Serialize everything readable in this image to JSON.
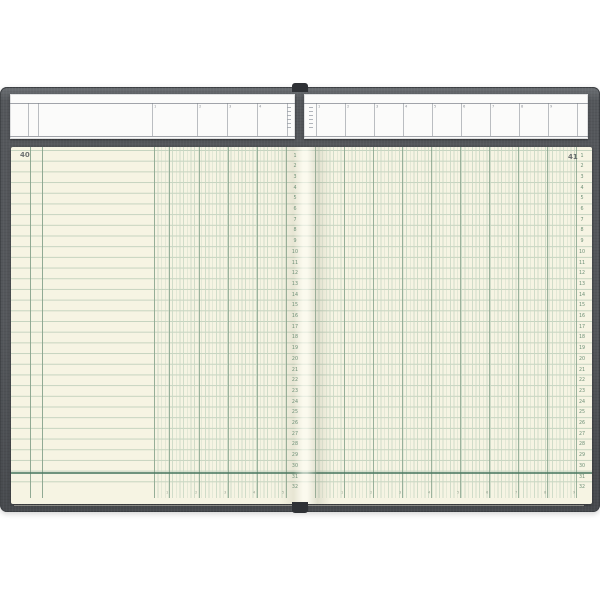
{
  "left_page": {
    "page_number": "40",
    "row_numbers": [
      "1",
      "2",
      "3",
      "4",
      "5",
      "6",
      "7",
      "8",
      "9",
      "10",
      "11",
      "12",
      "13",
      "14",
      "15",
      "16",
      "17",
      "18",
      "19",
      "20",
      "21",
      "22",
      "23",
      "24",
      "25",
      "26",
      "27",
      "28",
      "29",
      "30",
      "31",
      "32"
    ],
    "header_ticks": [
      "1",
      "2",
      "3",
      "4"
    ],
    "footer_ticks": [
      "1",
      "2",
      "3",
      "4",
      "5"
    ]
  },
  "right_page": {
    "page_number": "41",
    "row_numbers": [
      "1",
      "2",
      "3",
      "4",
      "5",
      "6",
      "7",
      "8",
      "9",
      "10",
      "11",
      "12",
      "13",
      "14",
      "15",
      "16",
      "17",
      "18",
      "19",
      "20",
      "21",
      "22",
      "23",
      "24",
      "25",
      "26",
      "27",
      "28",
      "29",
      "30",
      "31",
      "32"
    ],
    "header_ticks": [
      "1",
      "2",
      "3",
      "4",
      "5",
      "6",
      "7",
      "8",
      "9"
    ],
    "footer_ticks": [
      "1",
      "2",
      "3",
      "4",
      "5",
      "6",
      "7",
      "8",
      "9"
    ]
  },
  "colors": {
    "background": "#ffffff",
    "cover": "#54575b",
    "cover_edge": "#3d4044",
    "strip": "#fbfbfa",
    "header_rule": "#7a7f87",
    "page": "#f6f4e3",
    "rule_light": "#b9cbb6",
    "rule_sub": "#c9d8c4",
    "rule_dark": "#86a28b",
    "rule_heavy": "#4e7a63",
    "row_number": "#6f9178"
  }
}
